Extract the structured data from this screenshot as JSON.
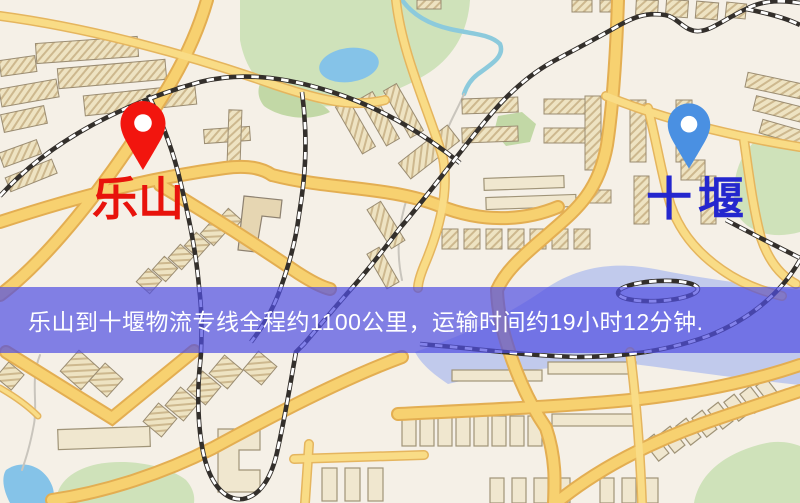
{
  "map": {
    "origin": {
      "label": "乐山",
      "pin_color": "#f2150e",
      "label_color": "#e8130c"
    },
    "destination": {
      "label": "十堰",
      "pin_color": "#4a90e2",
      "label_color": "#2427ce"
    }
  },
  "banner": {
    "text": "乐山到十堰物流专线全程约1100公里，运输时间约19小时12分钟.",
    "background_color": "#504ee2",
    "text_color": "#ffffff"
  }
}
